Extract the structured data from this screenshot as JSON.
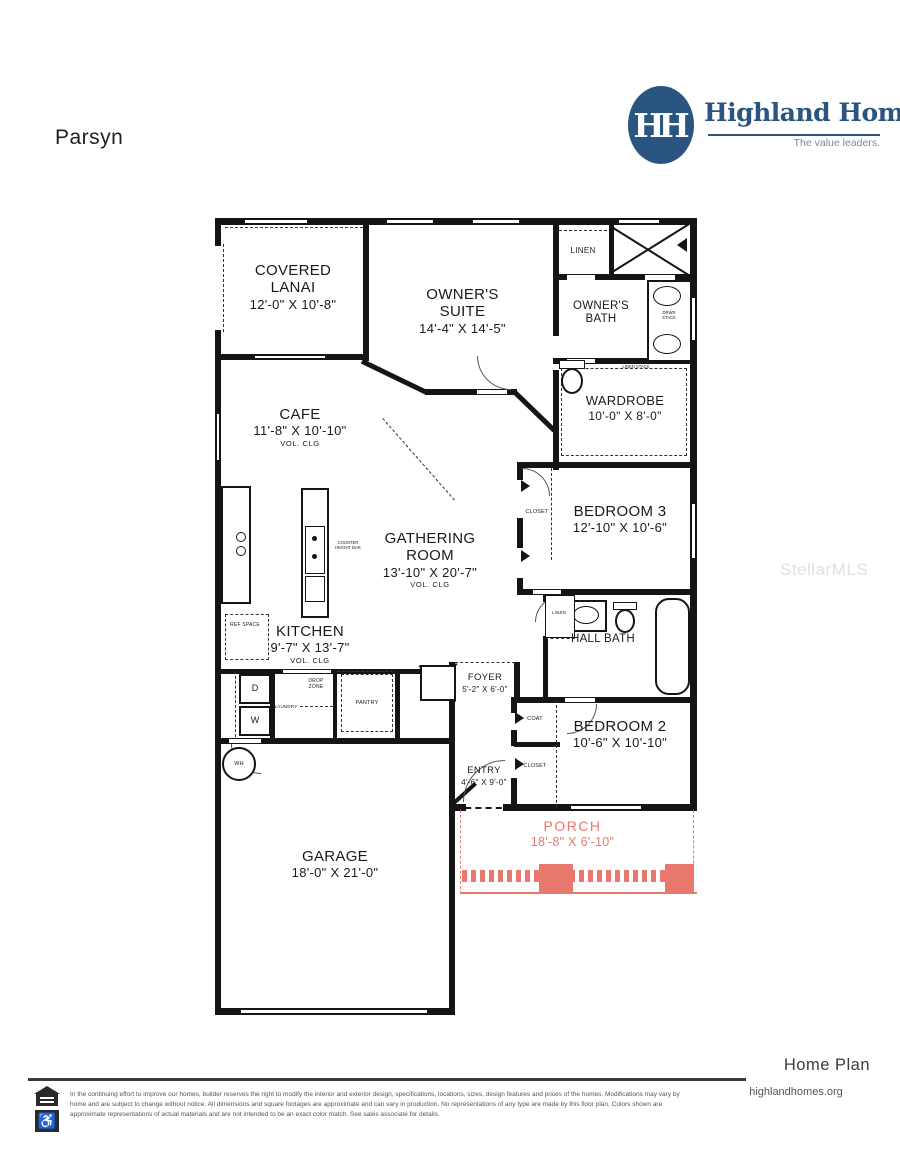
{
  "page": {
    "title": "Parsyn",
    "watermark": "StellarMLS"
  },
  "logo": {
    "monogram": "HH",
    "name": "Highland Homes",
    "tagline": "The value leaders.",
    "color": "#2a5580"
  },
  "plan": {
    "rooms": {
      "covered_lanai": {
        "name": "COVERED LANAI",
        "dims": "12'-0\" X 10'-8\""
      },
      "owners_suite": {
        "name": "OWNER'S SUITE",
        "dims": "14'-4\" X 14'-5\""
      },
      "linen": {
        "name": "LINEN"
      },
      "owners_bath": {
        "name": "OWNER'S BATH"
      },
      "wardrobe": {
        "name": "WARDROBE",
        "dims": "10'-0\" X 8'-0\""
      },
      "cafe": {
        "name": "CAFE",
        "dims": "11'-8\" X 10'-10\"",
        "note": "VOL. CLG"
      },
      "gathering": {
        "name": "GATHERING ROOM",
        "dims": "13'-10\" X 20'-7\"",
        "note": "VOL. CLG"
      },
      "kitchen": {
        "name": "KITCHEN",
        "dims": "9'-7\" X 13'-7\"",
        "note": "VOL. CLG"
      },
      "bedroom3": {
        "name": "BEDROOM 3",
        "dims": "12'-10\" X 10'-6\""
      },
      "hall_bath": {
        "name": "HALL BATH"
      },
      "bedroom2": {
        "name": "BEDROOM 2",
        "dims": "10'-6\" X 10'-10\""
      },
      "foyer": {
        "name": "FOYER",
        "dims": "5'-2\" X 6'-0\""
      },
      "entry": {
        "name": "ENTRY",
        "dims": "4'-6\" X 9'-0\""
      },
      "garage": {
        "name": "GARAGE",
        "dims": "18'-0\" X 21'-0\""
      },
      "porch": {
        "name": "PORCH",
        "dims": "18'-8\" X 6'-10\"",
        "color": "#e8786d"
      }
    },
    "labels": {
      "closet_b3": "CLOSET",
      "coat": "COAT",
      "closet_b2": "CLOSET",
      "linen_hall": "LINEN",
      "pantry": "PANTRY",
      "drop_zone": "DROP ZONE",
      "laundry": "LAUNDRY",
      "ref_space": "REF SPACE",
      "wh": "WH",
      "dryer": "D",
      "washer": "W",
      "counter_bar": "COUNTER HEIGHT BAR",
      "drwr_stack": "DRWR STACK",
      "linen_stack": "LINEN STACK"
    }
  },
  "footer": {
    "plan_type": "Home Plan",
    "website": "highlandhomes.org",
    "disclaimer": "In the continuing effort to improve our homes, builder reserves the right to modify the interior and exterior design, specifications, locations, sizes, design features and prices of the homes. Modifications may vary by home and are subject to change without notice. All dimensions and square footages are approximate and can vary in production. No representations of any type are made by this floor plan. Colors shown are approximate representations of actual materials and are not intended to be an exact color match. See sales associate for details."
  }
}
